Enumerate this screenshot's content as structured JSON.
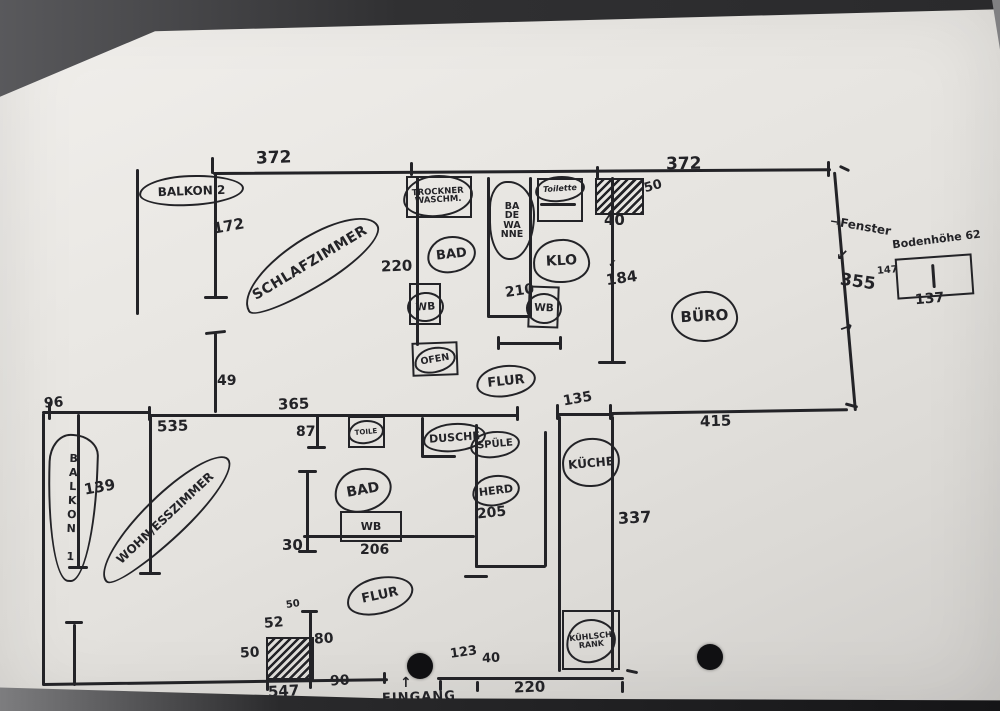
{
  "drawing": {
    "rooms": {
      "balkon2": "BALKON 2",
      "schlafzimmer": "SCHLAFZIMMER",
      "trockner": [
        "TROCKNER",
        "WASCHM."
      ],
      "bad_top": "BAD",
      "wb_top": "WB",
      "ofen": "OFEN",
      "badewanne": [
        "BA",
        "DE",
        "WA",
        "NNE"
      ],
      "toilette": "Toilette",
      "klo": "KLO",
      "wb_klo": "WB",
      "buero": "BÜRO",
      "flur_top": "FLUR",
      "balkon1": "BALKON 1",
      "wohn": "WOHN/ESSZIMMER",
      "toile": "TOILE",
      "dusche": "DUSCHE",
      "spuele": "SPÜLE",
      "herd": "HERD",
      "bad_low": "BAD",
      "wb_low": "WB",
      "flur_low": "FLUR",
      "kueche": "KÜCHE",
      "kuehlschrank": [
        "KÜHLSCH",
        "RANK"
      ],
      "eingang": "EINGANG",
      "fenster": "Fenster",
      "bodenhoehe": "Bodenhöhe 62"
    },
    "dims": {
      "t372l": "372",
      "t372r": "372",
      "h172": "172",
      "w220": "220",
      "w210": "210",
      "h184": "184",
      "n40": "40",
      "n50": "50",
      "r355": "355",
      "win147": "147",
      "win137": "137",
      "v49": "49",
      "l96": "96",
      "m535": "535",
      "m365": "365",
      "m87": "87",
      "m135": "135",
      "m415": "415",
      "b139": "139",
      "b30": "30",
      "b206": "206",
      "b205": "205",
      "k337": "337",
      "s50": "50",
      "s52": "52",
      "s80": "80",
      "l50": "50",
      "d90": "90",
      "b547": "547",
      "e123": "123",
      "e40": "40",
      "b220": "220"
    },
    "icons": {
      "arrow_right": "→",
      "arrow_up": "↑",
      "arrow_down_left": "↙",
      "check": "✓"
    }
  }
}
